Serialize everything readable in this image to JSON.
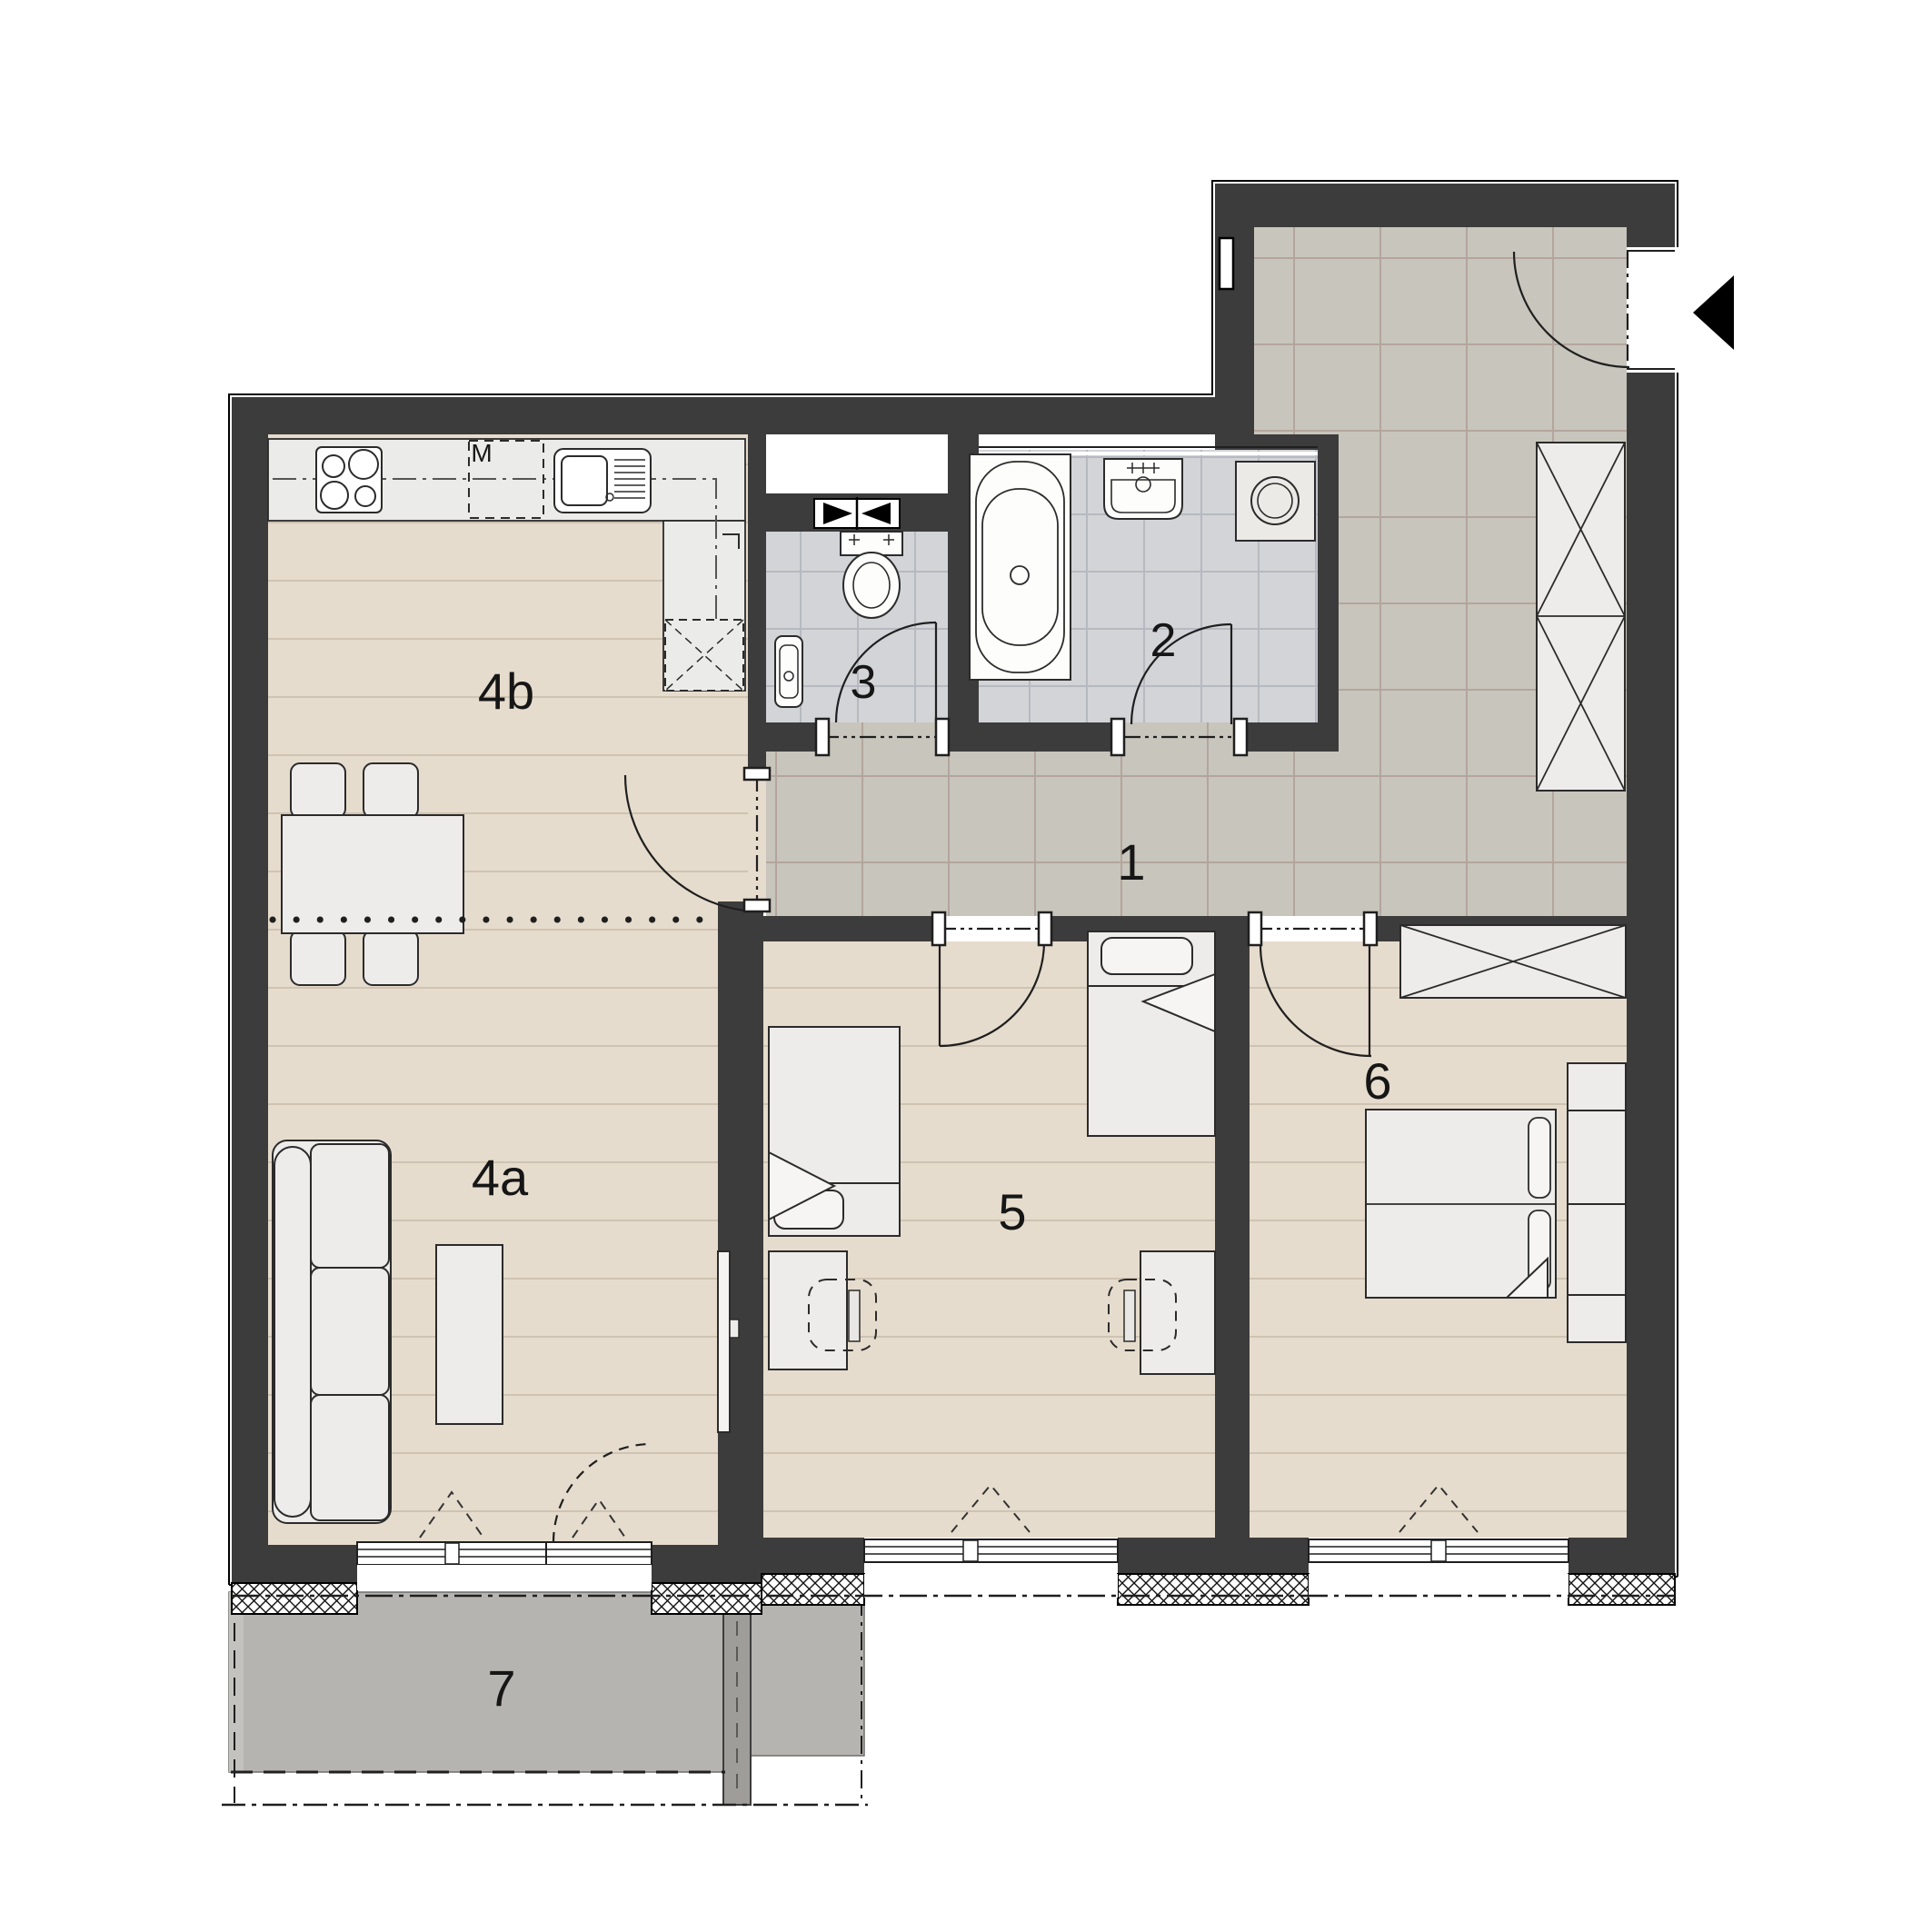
{
  "floorplan": {
    "room_labels": [
      {
        "room": "entrance-hall",
        "text": "1"
      },
      {
        "room": "bathroom",
        "text": "2"
      },
      {
        "room": "wc",
        "text": "3"
      },
      {
        "room": "living-room",
        "text": "4a"
      },
      {
        "room": "kitchen-dining",
        "text": "4b"
      },
      {
        "room": "bedroom-1",
        "text": "5"
      },
      {
        "room": "bedroom-2",
        "text": "6"
      },
      {
        "room": "balcony",
        "text": "7"
      }
    ],
    "appliance_labels": {
      "kitchen_appliance": "M"
    },
    "colors": {
      "wall": "#3d3c3c",
      "outline": "#1f1f1f",
      "wood_floor": "#e6dccd",
      "plank_line": "#cfc3b2",
      "corridor_tile": "#c8c5bc",
      "corridor_grout": "#b3a59d",
      "bath_tile": "#d3d4d8",
      "bath_grout": "#b6b9c0",
      "balcony_floor": "#b5b4b0",
      "furniture_fill": "#edecea",
      "entry_arrow": "#000000"
    }
  }
}
